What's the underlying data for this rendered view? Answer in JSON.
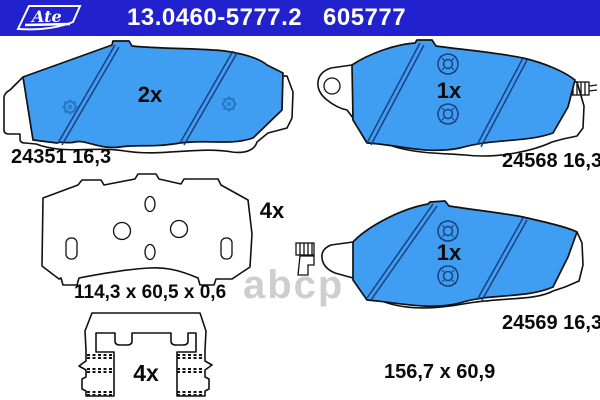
{
  "header": {
    "brand": "Ate",
    "part_number": "13.0460-5777.2",
    "ref_number": "605777",
    "bg_color": "#2121cd"
  },
  "parts": {
    "pad_outer": {
      "qty": "2x",
      "wva_number": "24351 16,3"
    },
    "pad_inner_right_top": {
      "qty": "1x",
      "wva_number": "24568 16,3"
    },
    "shim": {
      "qty": "4x",
      "dimensions": "114,3 x 60,5 x 0,6"
    },
    "pad_inner_right_bottom": {
      "qty": "1x",
      "wva_number": "24569 16,3"
    },
    "clip": {
      "qty": "4x"
    },
    "pad_dimensions": "156,7 x 60,9"
  },
  "watermark": "abcp",
  "colors": {
    "header_bg": "#2121cd",
    "pad_fill": "#3f9ef2",
    "chamfer_line": "#1c3f7e",
    "outline": "#111111",
    "watermark": "#c2c2c2"
  }
}
